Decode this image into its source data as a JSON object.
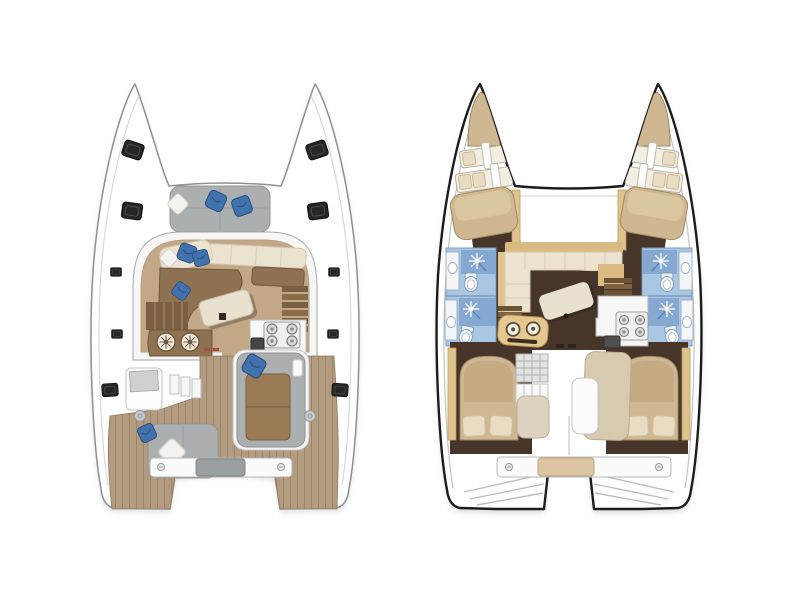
{
  "page": {
    "title": "Catamaran layout floor plans",
    "background": "#ffffff",
    "view_count": 2
  },
  "plans": [
    {
      "id": "deck-plan",
      "name": "deck-and-cockpit-level-plan",
      "position": "left",
      "features": [
        "bow-deck-hatches",
        "foredeck-sun-cushions",
        "saloon-lounge-sofa",
        "saloon-table",
        "port-hull-stairs",
        "starboard-hull-stairs",
        "galley-twin-round-sinks",
        "galley-four-burner-stove",
        "galley-sink",
        "cockpit-teak-deck",
        "cockpit-lounger",
        "cockpit-bench-seat",
        "aft-crossbeam-with-step",
        "twin-transom-platforms",
        "deck-winches"
      ],
      "counts": {
        "deck_hatches_per_hull": 5,
        "stove_burners": 4,
        "blue_pillows": 6,
        "white_pillows": 2
      }
    },
    {
      "id": "interior-plan",
      "name": "accommodation-level-plan",
      "position": "right",
      "features": [
        "forepeak-berths",
        "bow-bunk-berths",
        "forward-double-berths",
        "bathrooms-with-shower-and-toilet",
        "vanity-sinks",
        "saloon-corner-sofa",
        "rotated-saloon-table",
        "galley-four-burner-stove",
        "galley-twin-round-sinks",
        "hull-staircases",
        "companionway-steps",
        "aft-island-double-berths",
        "aft-cabin-chaise",
        "aft-crossbeam-with-pad",
        "twin-transom-platforms"
      ],
      "counts": {
        "bathrooms": 4,
        "double_berths": 4,
        "bunk_berths": 4,
        "stove_burners": 4
      }
    }
  ],
  "icons": {
    "hatch-icon": "dark rounded deck hatch",
    "pillow-blue-icon": "blue throw pillow",
    "pillow-white-icon": "white diamond pillow",
    "round-sink-icon": "round galley sink with cross detail",
    "burner-icon": "stove burner ring",
    "shower-icon": "white starburst shower spray",
    "toilet-icon": "toilet bowl top view",
    "screw-icon": "fastener on aft crossbeam",
    "winch-icon": "round deck winch"
  },
  "colors": {
    "background": "#ffffff",
    "hull_outline_light": "#8f8f8f",
    "hull_outline_dark": "#1c1c1c",
    "accent_blue": "#4272ad",
    "pillow_blue_dark": "#2a4d7e",
    "cushion_gray": "#abafb0",
    "teak": "#b29b7e",
    "teak_line": "#9d8668",
    "saloon_floor": "#c3a887",
    "settee_brown": "#8f7252",
    "upholstery_cream": "#ebe2cf",
    "table_cream": "#e9e1cf",
    "hatch_dark": "#262626",
    "interior_floor_dark": "#463528",
    "berth_tan": "#cfb791",
    "pillow_cream": "#e8dcc2",
    "bathroom_blue": "#a9c7e2",
    "bathroom_blue_dark": "#7d9cbd",
    "trim_tan": "#e0c28d",
    "galley_white": "#f6f6f6",
    "ghost_gray": "#c9c9c9"
  }
}
